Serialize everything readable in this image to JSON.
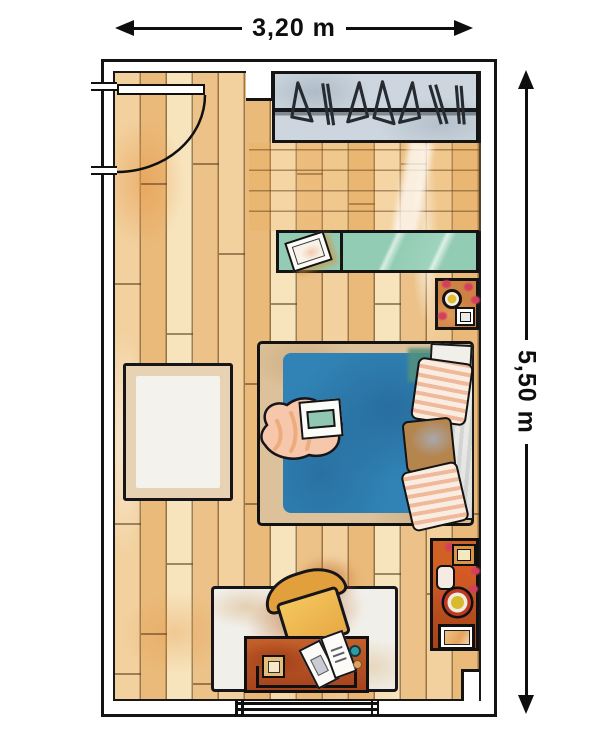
{
  "plan": {
    "title": "Bedroom floor plan sketch",
    "dimensions": {
      "width": {
        "label": "3,20 m"
      },
      "height": {
        "label": "5,50 m"
      }
    },
    "furniture": [
      {
        "id": "entry-door",
        "label": "entry door with swing arc"
      },
      {
        "id": "wardrobe",
        "label": "wardrobe with clothes rail and hangers"
      },
      {
        "id": "desk-shelf",
        "label": "wall-mounted teal shelf/desk"
      },
      {
        "id": "shelf-book",
        "label": "book on shelf"
      },
      {
        "id": "nightstand",
        "label": "bedside table with lamp and flowers"
      },
      {
        "id": "bed",
        "label": "double bed with blue duvet and striped pillows"
      },
      {
        "id": "bed-throw",
        "label": "peach throw blanket with tray"
      },
      {
        "id": "rug-left",
        "label": "rectangular rug"
      },
      {
        "id": "rug-bottom",
        "label": "rug with armchair"
      },
      {
        "id": "armchair",
        "label": "orange armchair"
      },
      {
        "id": "low-table",
        "label": "rust low table with open book"
      },
      {
        "id": "dresser",
        "label": "chest with lamp, box and tray"
      },
      {
        "id": "window",
        "label": "window in bottom wall"
      }
    ],
    "colors": {
      "floor_light": "#f7e4bd",
      "floor_mid": "#f2d19f",
      "floor_dark": "#eaba7a",
      "wardrobe_grey": "#cdd6de",
      "shelf_teal": "#93ccb4",
      "bed_blue": "#3183b5",
      "pillow_stripe": "#f1b99c",
      "chair_orange": "#eeb24a",
      "table_rust": "#b5501f",
      "flower_red": "#d53f5e",
      "outline": "#101010"
    }
  }
}
